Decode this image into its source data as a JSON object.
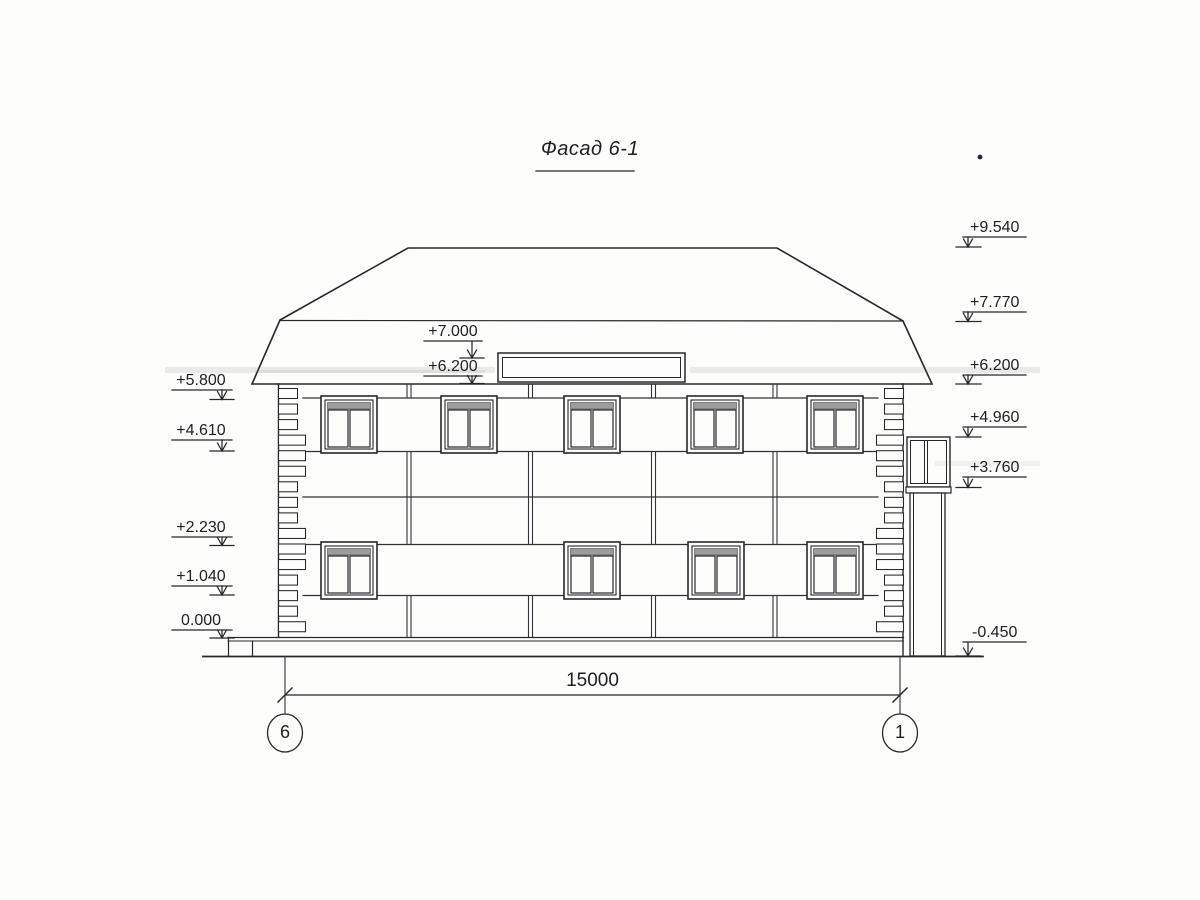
{
  "title": "Фасад 6-1",
  "elevation_marks": {
    "right": [
      {
        "label": "+9.540"
      },
      {
        "label": "+7.770"
      },
      {
        "label": "+6.200"
      },
      {
        "label": "+4.960"
      },
      {
        "label": "+3.760"
      },
      {
        "label": "-0.450"
      }
    ],
    "left": [
      {
        "label": "+5.800"
      },
      {
        "label": "+4.610"
      },
      {
        "label": "+2.230"
      },
      {
        "label": "+1.040"
      },
      {
        "label": "0.000"
      }
    ],
    "middle": [
      {
        "label": "+7.000"
      },
      {
        "label": "+6.200"
      }
    ]
  },
  "dimension": {
    "label": "15000"
  },
  "axes": [
    {
      "label": "6"
    },
    {
      "label": "1"
    }
  ],
  "colors": {
    "ink": "#26282b",
    "paper": "#fdfdfc"
  }
}
